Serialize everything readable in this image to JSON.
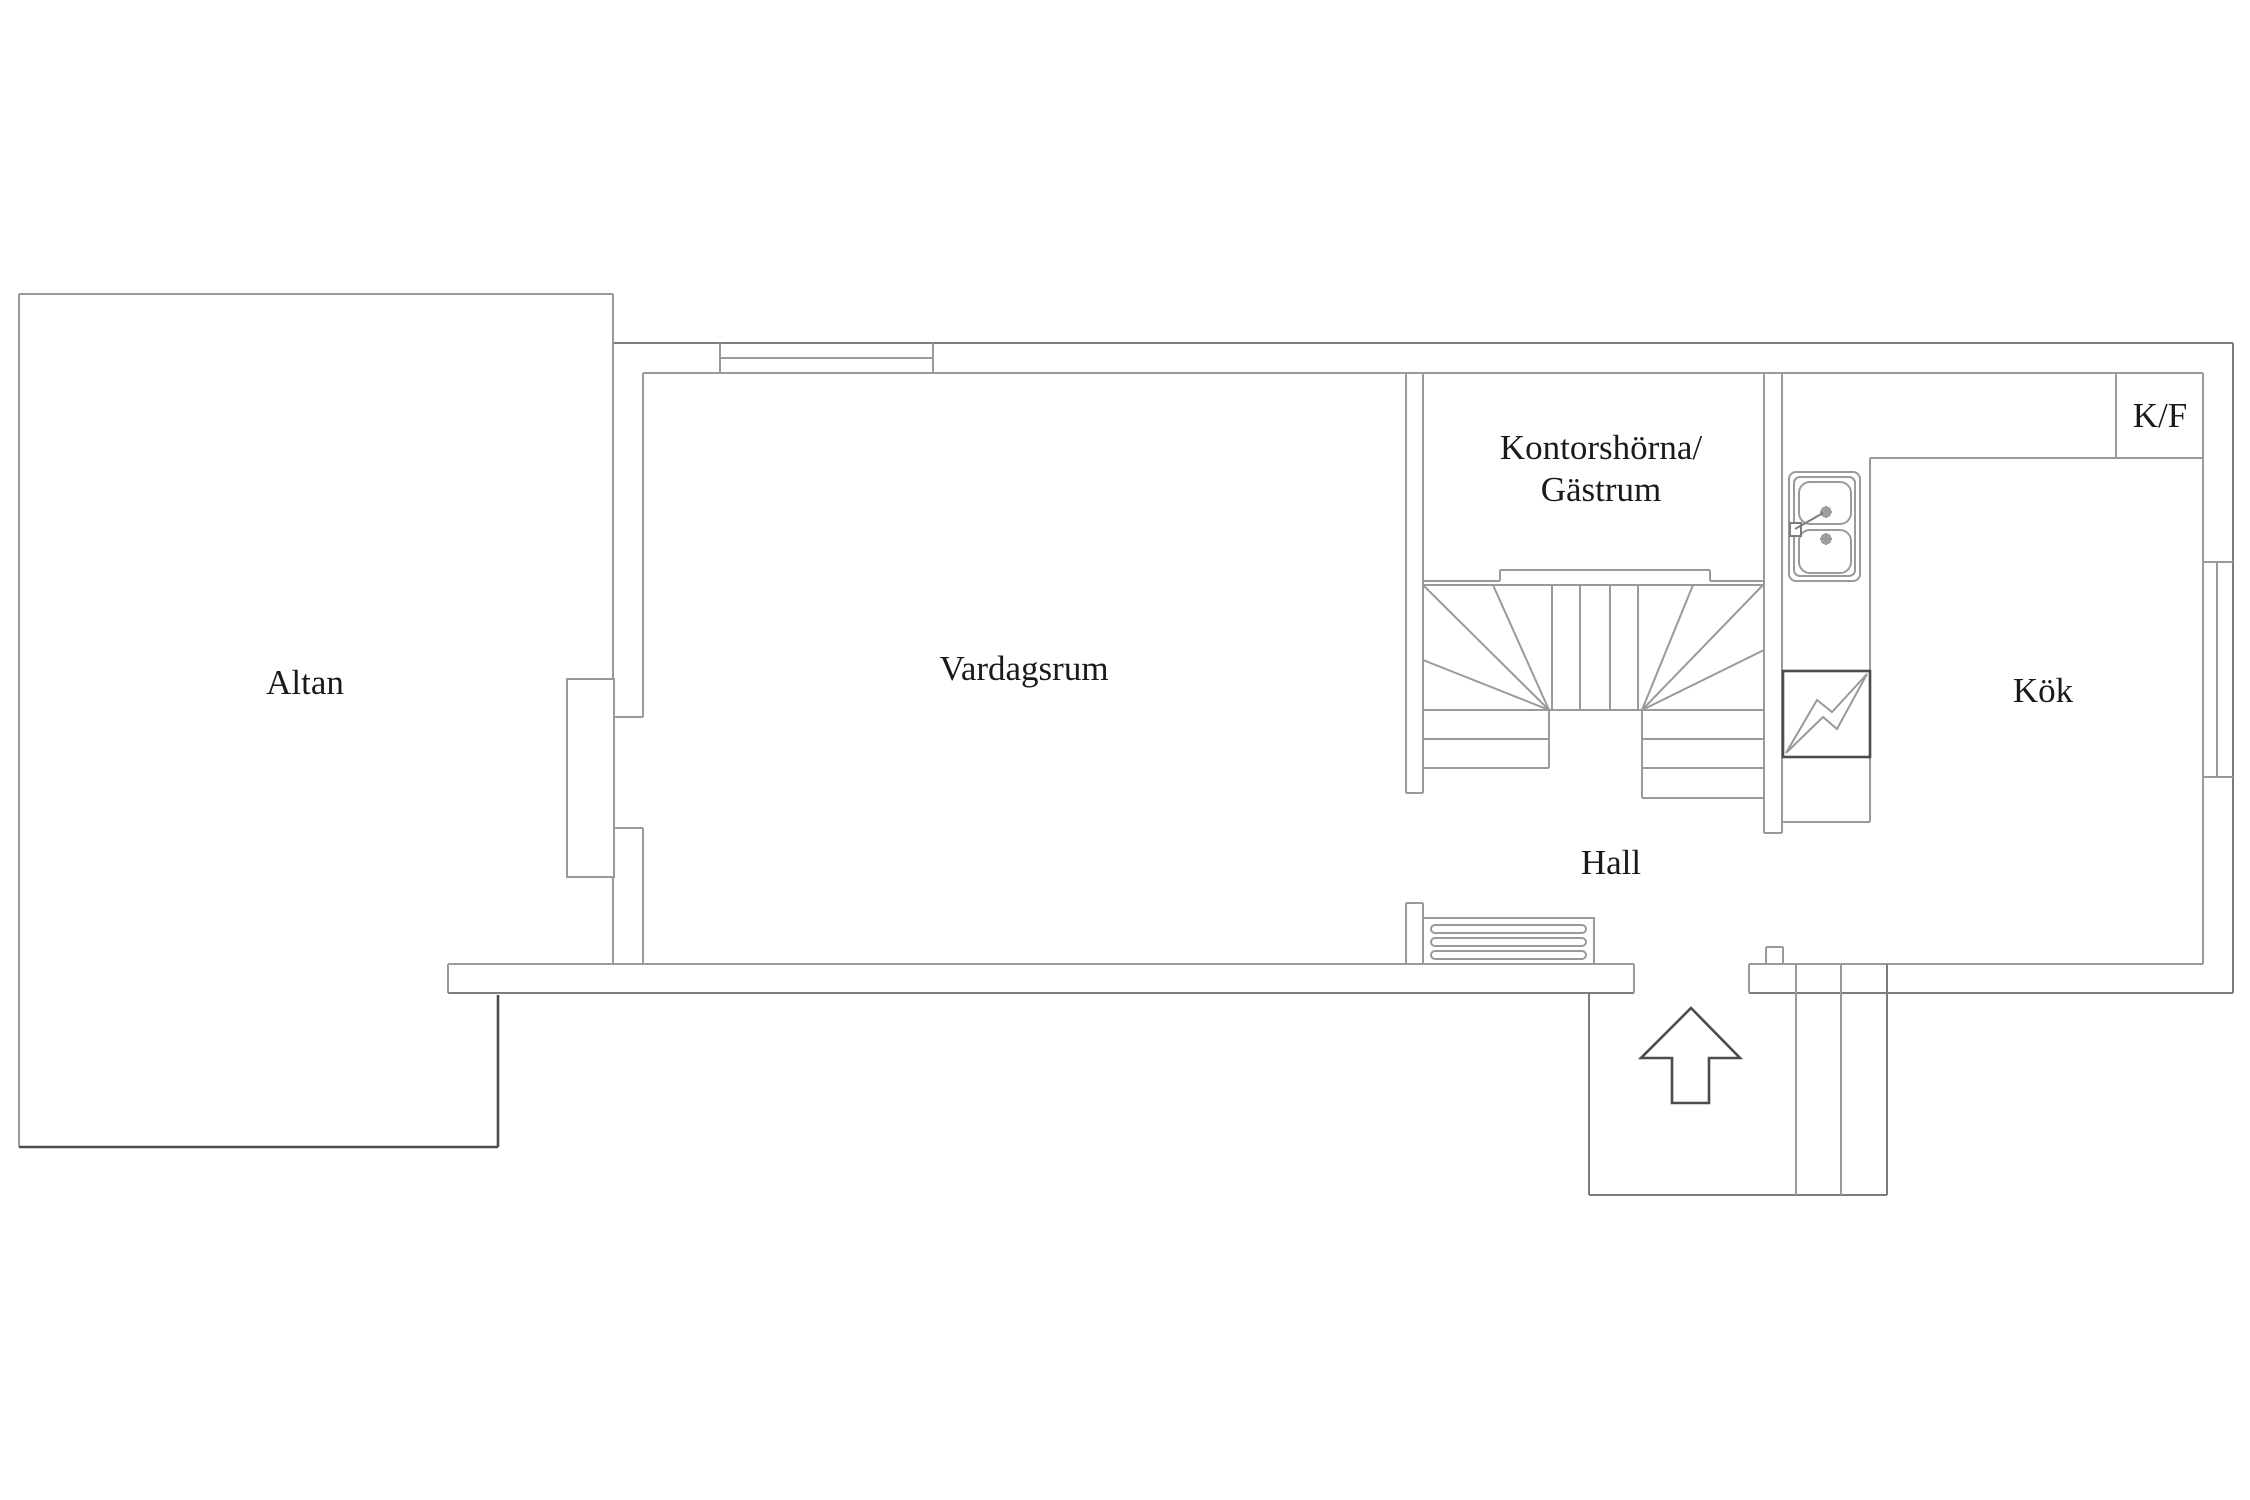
{
  "floor_plan": {
    "rooms": {
      "altan": "Altan",
      "vardagsrum": "Vardagsrum",
      "kontorshorna_line1": "Kontorshörna/",
      "kontorshorna_line2": "Gästrum",
      "hall": "Hall",
      "kok": "Kök",
      "kf": "K/F"
    },
    "icons": {
      "sink": "double-bowl-kitchen-sink-icon",
      "appliance": "dishwasher-zigzag-icon",
      "radiator": "radiator-grille-icon",
      "entrance": "entrance-arrow-icon",
      "stairs": "winder-staircase-icon",
      "windows": "window-icon"
    },
    "colors": {
      "line_light": "#9a9a9a",
      "line_mid": "#7d7d7d",
      "line_dark": "#4c4c4c",
      "text": "#1a1a1a",
      "background": "#ffffff"
    }
  }
}
